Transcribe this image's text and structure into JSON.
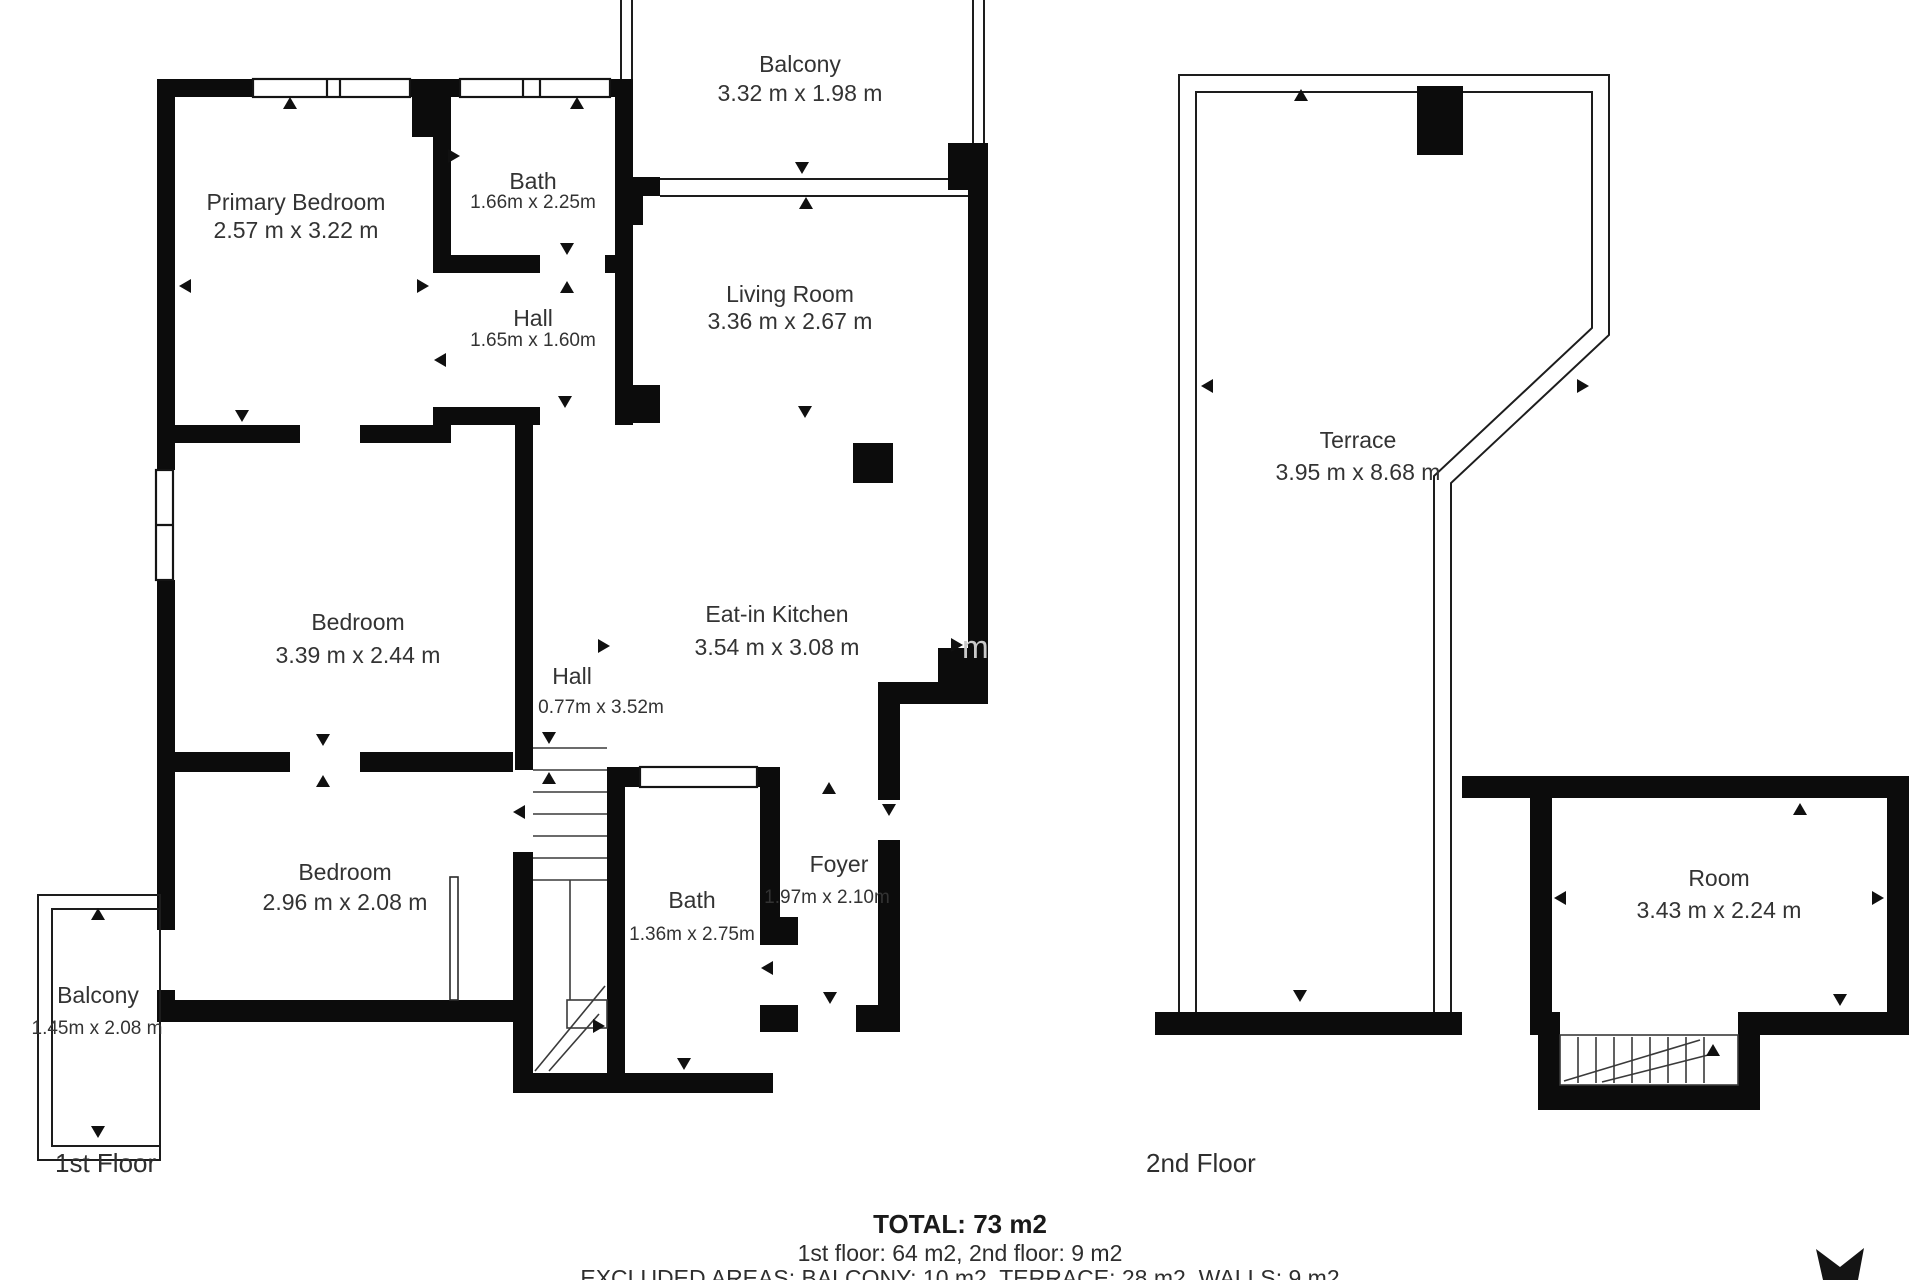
{
  "colors": {
    "walls": "#0c0c0c",
    "text": "#333333",
    "background": "#ffffff"
  },
  "floors": {
    "first": {
      "label": "1st Floor",
      "rooms": {
        "primary_bedroom": {
          "name": "Primary Bedroom",
          "dims": "2.57 m x 3.22 m"
        },
        "bath_top": {
          "name": "Bath",
          "dims": "1.66m x 2.25m"
        },
        "hall_top": {
          "name": "Hall",
          "dims": "1.65m x 1.60m"
        },
        "balcony_top": {
          "name": "Balcony",
          "dims": "3.32 m x 1.98 m"
        },
        "living_room": {
          "name": "Living Room",
          "dims": "3.36 m x 2.67 m"
        },
        "kitchen": {
          "name": "Eat-in Kitchen",
          "dims": "3.54 m x 3.08 m"
        },
        "bedroom_mid": {
          "name": "Bedroom",
          "dims": "3.39 m x 2.44 m"
        },
        "hall_mid": {
          "name": "Hall",
          "dims": "0.77m x 3.52m"
        },
        "balcony_left": {
          "name": "Balcony",
          "dims": "1.45m x 2.08 m"
        },
        "bedroom_low": {
          "name": "Bedroom",
          "dims": "2.96 m x 2.08 m"
        },
        "bath_low": {
          "name": "Bath",
          "dims": "1.36m x 2.75m"
        },
        "foyer": {
          "name": "Foyer",
          "dims": "1.97m x 2.10m"
        }
      }
    },
    "second": {
      "label": "2nd Floor",
      "rooms": {
        "terrace": {
          "name": "Terrace",
          "dims": "3.95 m x 8.68 m"
        },
        "room": {
          "name": "Room",
          "dims": "3.43 m x 2.24 m"
        }
      }
    }
  },
  "footer": {
    "total": "TOTAL: 73 m2",
    "per_floor": "1st floor: 64 m2, 2nd floor: 9 m2",
    "excluded": "EXCLUDED AREAS: BALCONY: 10 m2, TERRACE: 28 m2, WALLS: 9 m2"
  },
  "watermark": {
    "text": "m"
  }
}
